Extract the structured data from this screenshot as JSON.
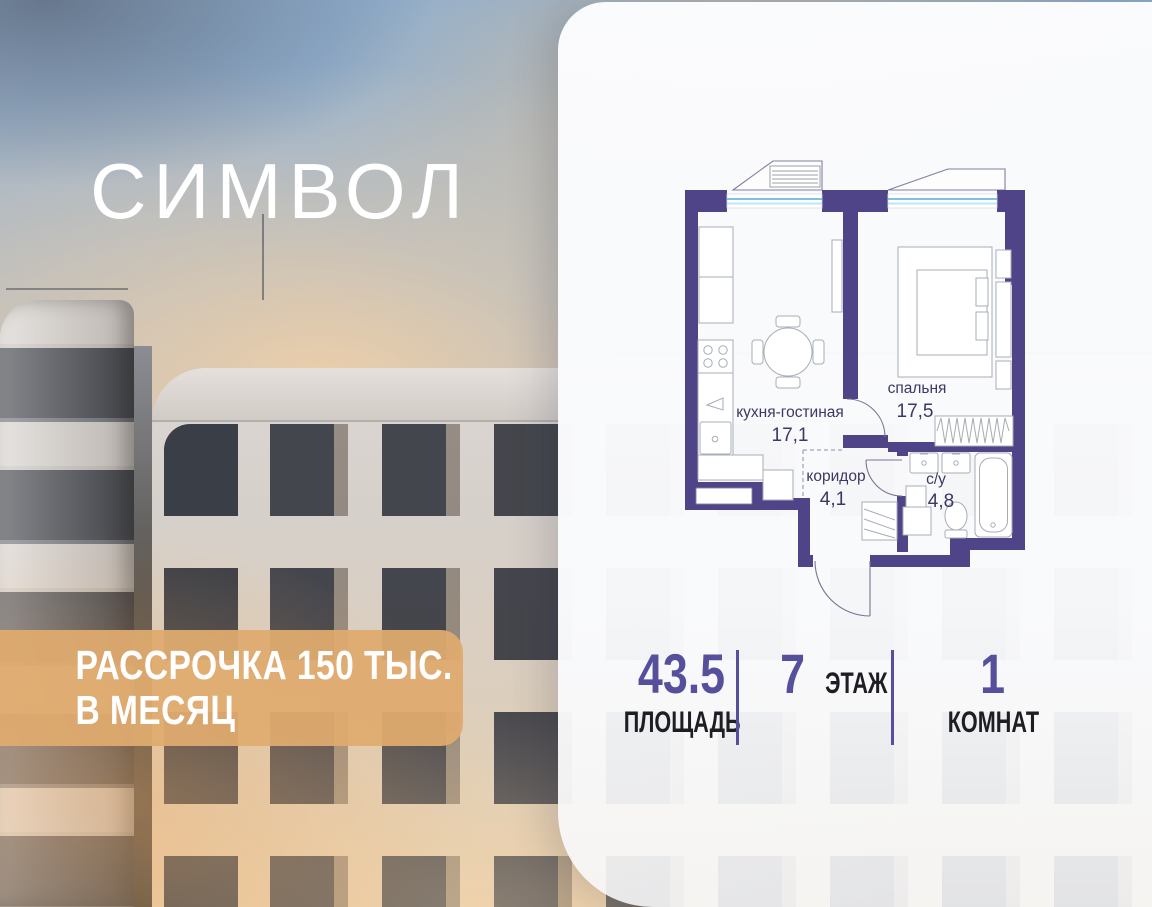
{
  "project": {
    "name": "СИМВОЛ"
  },
  "banner": {
    "line1": "РАССРОЧКА 150 ТЫС.",
    "line2": "В МЕСЯЦ",
    "bg_color": "#dfab6e"
  },
  "floorplan": {
    "wall_color": "#4e4487",
    "window_color": "#7ec3e6",
    "rooms": [
      {
        "name": "кухня-гостиная",
        "area": "17,1"
      },
      {
        "name": "спальня",
        "area": "17,5"
      },
      {
        "name": "коридор",
        "area": "4,1"
      },
      {
        "name": "с/у",
        "area": "4,8"
      }
    ]
  },
  "stats": [
    {
      "value": "43.5",
      "label": "ПЛОЩАДЬ"
    },
    {
      "value": "7",
      "label": "ЭТАЖ"
    },
    {
      "value": "1",
      "label": "КОМНАТ"
    }
  ],
  "colors": {
    "accent": "#56509c",
    "label": "#1d1d24"
  }
}
